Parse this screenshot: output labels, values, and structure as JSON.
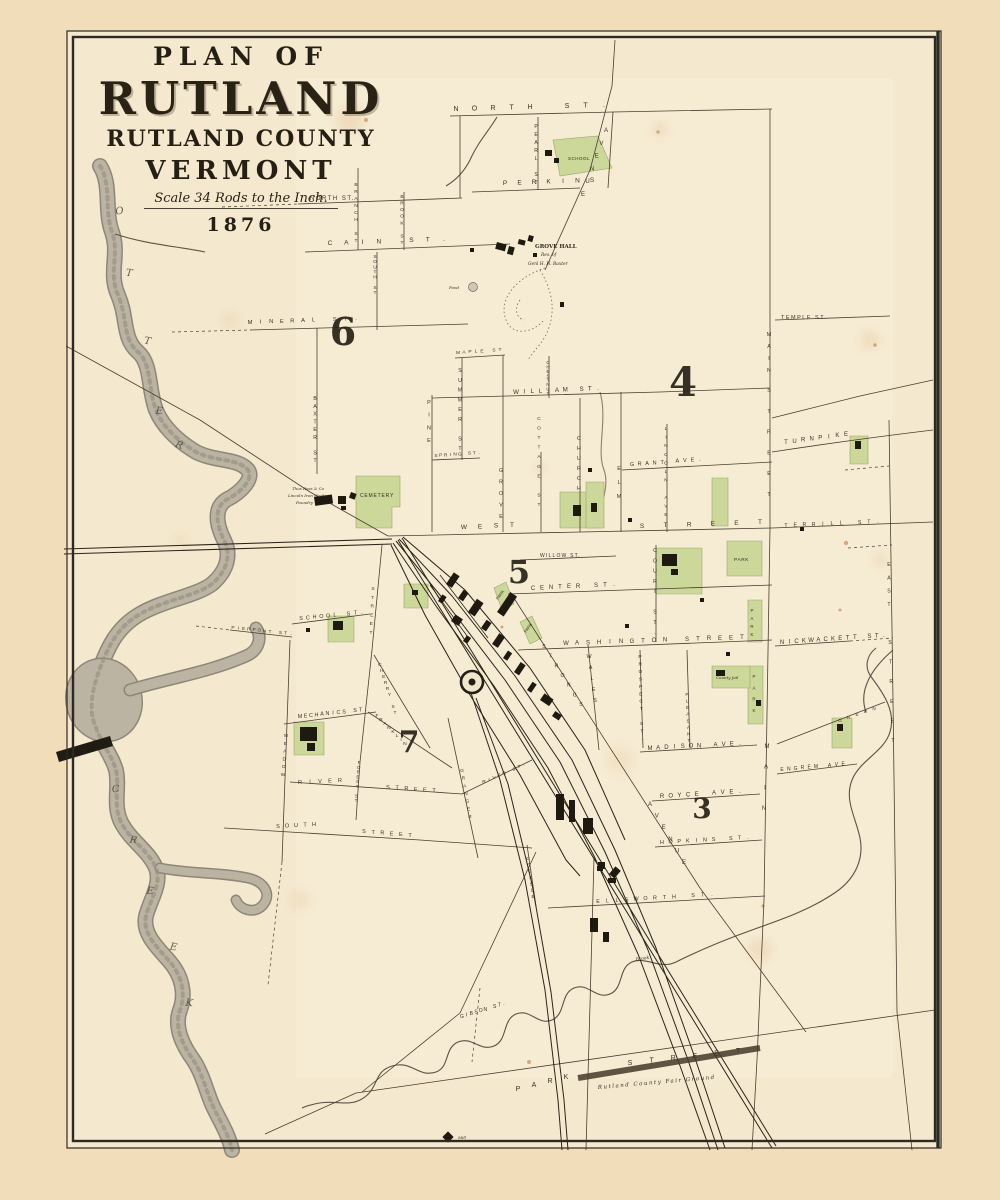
{
  "title_block": {
    "line1": "PLAN OF",
    "line2": "RUTLAND",
    "line3": "RUTLAND COUNTY",
    "line4": "VERMONT",
    "scale": "Scale 34 Rods to the Inch.",
    "year": "1876"
  },
  "colors": {
    "paper_margin": "#f2ddbb",
    "paper_map": "#f4e9cf",
    "park_green": "#ccd79a",
    "ink": "#3b3226",
    "water_gray": "#b7af9d",
    "building_black": "#1f1a10"
  },
  "map": {
    "district_numbers": [
      {
        "t": "6",
        "x": 343,
        "y": 345,
        "s": 38
      },
      {
        "t": "4",
        "x": 683,
        "y": 396,
        "s": 40
      },
      {
        "t": "5",
        "x": 519,
        "y": 583,
        "s": 32
      },
      {
        "t": "7",
        "x": 409,
        "y": 752,
        "s": 30
      },
      {
        "t": "3",
        "x": 702,
        "y": 818,
        "s": 28
      }
    ],
    "street_labels": [
      {
        "t": "NORTH ST.",
        "x": 456,
        "y": 111,
        "x2": 604,
        "y2": 107,
        "s": 7
      },
      {
        "t": "NORTH ST.",
        "x": 310,
        "y": 200,
        "s": 6,
        "ls": 1.5
      },
      {
        "t": "PEARL ST",
        "x": 536,
        "y": 128,
        "x2": 536,
        "y2": 184,
        "s": 5
      },
      {
        "t": "PERKINS",
        "x": 505,
        "y": 185,
        "x2": 592,
        "y2": 182,
        "s": 6.5
      },
      {
        "t": "AVENUE",
        "x": 606,
        "y": 132,
        "x2": 583,
        "y2": 196,
        "s": 6
      },
      {
        "t": "BRANCH ST",
        "x": 356,
        "y": 186,
        "x2": 356,
        "y2": 242,
        "s": 4.8
      },
      {
        "t": "BROOK ST",
        "x": 402,
        "y": 198,
        "x2": 402,
        "y2": 244,
        "s": 4.8
      },
      {
        "t": "CAIN ST.",
        "x": 330,
        "y": 245,
        "x2": 444,
        "y2": 241,
        "s": 6.5
      },
      {
        "t": "SOUTH ST",
        "x": 375,
        "y": 258,
        "x2": 375,
        "y2": 294,
        "s": 4.8
      },
      {
        "t": "MINERAL ST.",
        "x": 250,
        "y": 324,
        "x2": 356,
        "y2": 320,
        "s": 5.8
      },
      {
        "t": "BAXTER ST",
        "x": 315,
        "y": 400,
        "x2": 315,
        "y2": 462,
        "s": 5
      },
      {
        "t": "MAPLE ST",
        "x": 458,
        "y": 354,
        "x2": 500,
        "y2": 351,
        "s": 4.8
      },
      {
        "t": "SUMMER ST",
        "x": 460,
        "y": 372,
        "x2": 460,
        "y2": 450,
        "s": 5.2
      },
      {
        "t": "PINE",
        "x": 429,
        "y": 404,
        "x2": 429,
        "y2": 442,
        "s": 5.5
      },
      {
        "t": "SPRING ST.",
        "x": 436,
        "y": 457,
        "x2": 479,
        "y2": 454,
        "s": 4.8
      },
      {
        "t": "WILLIAM ST.",
        "x": 516,
        "y": 394,
        "x2": 598,
        "y2": 390,
        "s": 6.2
      },
      {
        "t": "CHESTNUT",
        "x": 548,
        "y": 364,
        "x2": 548,
        "y2": 395,
        "s": 4.5
      },
      {
        "t": "CHURCH",
        "x": 579,
        "y": 440,
        "x2": 579,
        "y2": 490,
        "s": 5.4
      },
      {
        "t": "ELM",
        "x": 619,
        "y": 470,
        "x2": 619,
        "y2": 498,
        "s": 5.4
      },
      {
        "t": "COTTAGE ST",
        "x": 539,
        "y": 420,
        "x2": 539,
        "y2": 506,
        "s": 4.8
      },
      {
        "t": "GROVE",
        "x": 501,
        "y": 472,
        "x2": 501,
        "y2": 518,
        "s": 5.2
      },
      {
        "t": "GRANT AVE.",
        "x": 632,
        "y": 466,
        "x2": 700,
        "y2": 461,
        "s": 5.5
      },
      {
        "t": "LINCOLN AVE",
        "x": 666,
        "y": 430,
        "x2": 666,
        "y2": 516,
        "s": 4.8
      },
      {
        "t": "TEMPLE ST.",
        "x": 781,
        "y": 319,
        "s": 5.5,
        "ls": 1.5
      },
      {
        "t": "TURNPIKE",
        "x": 786,
        "y": 444,
        "x2": 846,
        "y2": 436,
        "s": 6
      },
      {
        "t": "MAIN",
        "x": 769,
        "y": 336,
        "x2": 769,
        "y2": 372,
        "s": 5.4
      },
      {
        "t": "STREET",
        "x": 769,
        "y": 392,
        "x2": 769,
        "y2": 496,
        "s": 5.4
      },
      {
        "t": "WEST",
        "x": 464,
        "y": 529,
        "x2": 512,
        "y2": 527,
        "s": 6.5
      },
      {
        "t": "STREET",
        "x": 642,
        "y": 528,
        "x2": 760,
        "y2": 524,
        "s": 6.5
      },
      {
        "t": "TERRILL ST.",
        "x": 786,
        "y": 527,
        "x2": 878,
        "y2": 523,
        "s": 5.2
      },
      {
        "t": "MAIN",
        "x": 767,
        "y": 748,
        "x2": 764,
        "y2": 810,
        "s": 6
      },
      {
        "t": "EAST",
        "x": 889,
        "y": 566,
        "x2": 889,
        "y2": 606,
        "s": 5.2
      },
      {
        "t": "STREET",
        "x": 890,
        "y": 644,
        "x2": 893,
        "y2": 742,
        "s": 5.2
      },
      {
        "t": "CENTER ST.",
        "x": 533,
        "y": 590,
        "x2": 614,
        "y2": 586,
        "s": 6
      },
      {
        "t": "WILLOW ST.",
        "x": 540,
        "y": 557,
        "s": 5,
        "ls": 1.2
      },
      {
        "t": "COURT ST.",
        "x": 655,
        "y": 552,
        "x2": 655,
        "y2": 634,
        "s": 5.2
      },
      {
        "t": "WASHINGTON STREET",
        "x": 566,
        "y": 645,
        "x2": 742,
        "y2": 639,
        "s": 6
      },
      {
        "t": "WALES",
        "x": 589,
        "y": 658,
        "x2": 595,
        "y2": 702,
        "s": 5.4
      },
      {
        "t": "STRONGS",
        "x": 544,
        "y": 648,
        "x2": 581,
        "y2": 706,
        "s": 5.2
      },
      {
        "t": "AVENUE",
        "x": 650,
        "y": 806,
        "x2": 684,
        "y2": 864,
        "s": 6
      },
      {
        "t": "PROSPECT ST.",
        "x": 640,
        "y": 658,
        "x2": 642,
        "y2": 740,
        "s": 4.8
      },
      {
        "t": "PLEASANT",
        "x": 687,
        "y": 696,
        "x2": 689,
        "y2": 742,
        "s": 4.8
      },
      {
        "t": "MADISON AVE.",
        "x": 650,
        "y": 750,
        "x2": 740,
        "y2": 745,
        "s": 6
      },
      {
        "t": "ROYCE AVE.",
        "x": 662,
        "y": 798,
        "x2": 740,
        "y2": 793,
        "s": 6
      },
      {
        "t": "HOPKINS ST.",
        "x": 662,
        "y": 844,
        "x2": 748,
        "y2": 839,
        "s": 5.4
      },
      {
        "t": "ELLSWORTH ST.",
        "x": 598,
        "y": 903,
        "x2": 712,
        "y2": 896,
        "s": 5.4
      },
      {
        "t": "ENGREM AVE.",
        "x": 782,
        "y": 771,
        "x2": 850,
        "y2": 765,
        "s": 5
      },
      {
        "t": "NICKWACKETT ST.",
        "x": 782,
        "y": 644,
        "x2": 884,
        "y2": 637,
        "s": 6
      },
      {
        "t": "GREEN",
        "x": 840,
        "y": 722,
        "x2": 874,
        "y2": 710,
        "s": 4.6
      },
      {
        "t": "RIVER",
        "x": 300,
        "y": 784,
        "x2": 340,
        "y2": 782,
        "s": 5.5
      },
      {
        "t": "STREET",
        "x": 388,
        "y": 789,
        "x2": 434,
        "y2": 792,
        "s": 5.5
      },
      {
        "t": "RIVER ST.",
        "x": 484,
        "y": 783,
        "x2": 524,
        "y2": 766,
        "s": 4.8
      },
      {
        "t": "SOUTH",
        "x": 278,
        "y": 828,
        "x2": 314,
        "y2": 826,
        "s": 5.5
      },
      {
        "t": "STREET",
        "x": 364,
        "y": 833,
        "x2": 410,
        "y2": 837,
        "s": 5.5
      },
      {
        "t": "FOREST ST",
        "x": 359,
        "y": 764,
        "x2": 356,
        "y2": 802,
        "s": 4.6
      },
      {
        "t": "GRANGER",
        "x": 462,
        "y": 772,
        "x2": 470,
        "y2": 818,
        "s": 4.8
      },
      {
        "t": "CROSSLE",
        "x": 528,
        "y": 860,
        "x2": 533,
        "y2": 898,
        "s": 4.6
      },
      {
        "t": "MEADOW",
        "x": 286,
        "y": 737,
        "x2": 283,
        "y2": 776,
        "s": 4.8
      },
      {
        "t": "PIERPONT ST.",
        "x": 233,
        "y": 629,
        "x2": 291,
        "y2": 635,
        "s": 4.8
      },
      {
        "t": "SCHOOL ST.",
        "x": 301,
        "y": 620,
        "x2": 362,
        "y2": 614,
        "s": 5.4
      },
      {
        "t": "STREET",
        "x": 373,
        "y": 590,
        "x2": 371,
        "y2": 634,
        "s": 4.8
      },
      {
        "t": "CHERRY ST",
        "x": 380,
        "y": 666,
        "x2": 395,
        "y2": 714,
        "s": 4.8
      },
      {
        "t": "FRANKLIN",
        "x": 377,
        "y": 717,
        "x2": 405,
        "y2": 745,
        "s": 4.8
      },
      {
        "t": "MECHANICS ST.",
        "x": 300,
        "y": 718,
        "x2": 366,
        "y2": 711,
        "s": 5.4
      },
      {
        "t": "GIBSON ST.",
        "x": 462,
        "y": 1018,
        "x2": 504,
        "y2": 1005,
        "s": 5
      },
      {
        "t": "PARK",
        "x": 518,
        "y": 1091,
        "x2": 566,
        "y2": 1079,
        "s": 7
      },
      {
        "t": "STREET",
        "x": 630,
        "y": 1065,
        "x2": 738,
        "y2": 1053,
        "s": 7
      },
      {
        "t": "PARK",
        "x": 752,
        "y": 612,
        "x2": 752,
        "y2": 636,
        "s": 4.4
      },
      {
        "t": "PARK",
        "x": 754,
        "y": 678,
        "x2": 754,
        "y2": 712,
        "s": 4.4
      }
    ],
    "place_labels": [
      {
        "t": "SCHOOL",
        "x": 568,
        "y": 160,
        "s": 4.5,
        "ls": 0.5
      },
      {
        "t": "GROVE HALL",
        "x": 535,
        "y": 248,
        "s": 5.5,
        "b": 1
      },
      {
        "t": "Res. of",
        "x": 541,
        "y": 256,
        "s": 4.4,
        "i": 1
      },
      {
        "t": "Genl H. H. Baxter",
        "x": 528,
        "y": 265,
        "s": 4.4,
        "i": 1
      },
      {
        "t": "Pond",
        "x": 449,
        "y": 289,
        "s": 4,
        "i": 1
      },
      {
        "t": "CEMETERY",
        "x": 360,
        "y": 497,
        "s": 5,
        "ls": 0.8
      },
      {
        "t": "Thos Ross & Co",
        "x": 292,
        "y": 490,
        "s": 4,
        "i": 1
      },
      {
        "t": "Lincoln Iron Works",
        "x": 288,
        "y": 497,
        "s": 4,
        "i": 1
      },
      {
        "t": "Foundry",
        "x": 296,
        "y": 504,
        "s": 4,
        "i": 1
      },
      {
        "t": "PARK",
        "x": 734,
        "y": 561,
        "s": 4.8,
        "ls": 0.6
      },
      {
        "t": "County Jail",
        "x": 716,
        "y": 679,
        "s": 4,
        "i": 1
      },
      {
        "t": "PARK",
        "x": 498,
        "y": 600,
        "s": 4,
        "r": -53
      },
      {
        "t": "PARK",
        "x": 526,
        "y": 633,
        "s": 4,
        "r": -53
      },
      {
        "t": "Rutland  County  Fair  Ground",
        "x": 598,
        "y": 1089,
        "s": 5.5,
        "i": 1,
        "r": -5,
        "ls": 1.5
      },
      {
        "t": "Mill",
        "x": 458,
        "y": 1139,
        "s": 4,
        "i": 1
      },
      {
        "t": "Brook",
        "x": 636,
        "y": 961,
        "s": 4.5,
        "i": 1,
        "r": -10
      }
    ],
    "water_letters": [
      {
        "t": "O",
        "x": 120,
        "y": 214,
        "r": -8
      },
      {
        "t": "T",
        "x": 129,
        "y": 276,
        "r": 5
      },
      {
        "t": "T",
        "x": 147,
        "y": 344,
        "r": 10
      },
      {
        "t": "E",
        "x": 159,
        "y": 414,
        "r": 5
      },
      {
        "t": "R",
        "x": 178,
        "y": 448,
        "r": 20
      },
      {
        "t": "C",
        "x": 116,
        "y": 792,
        "r": -5
      },
      {
        "t": "R",
        "x": 133,
        "y": 843,
        "r": 8
      },
      {
        "t": "E",
        "x": 150,
        "y": 894,
        "r": 5
      },
      {
        "t": "E",
        "x": 173,
        "y": 950,
        "r": 10
      },
      {
        "t": "K",
        "x": 189,
        "y": 1006,
        "r": 5
      }
    ]
  }
}
